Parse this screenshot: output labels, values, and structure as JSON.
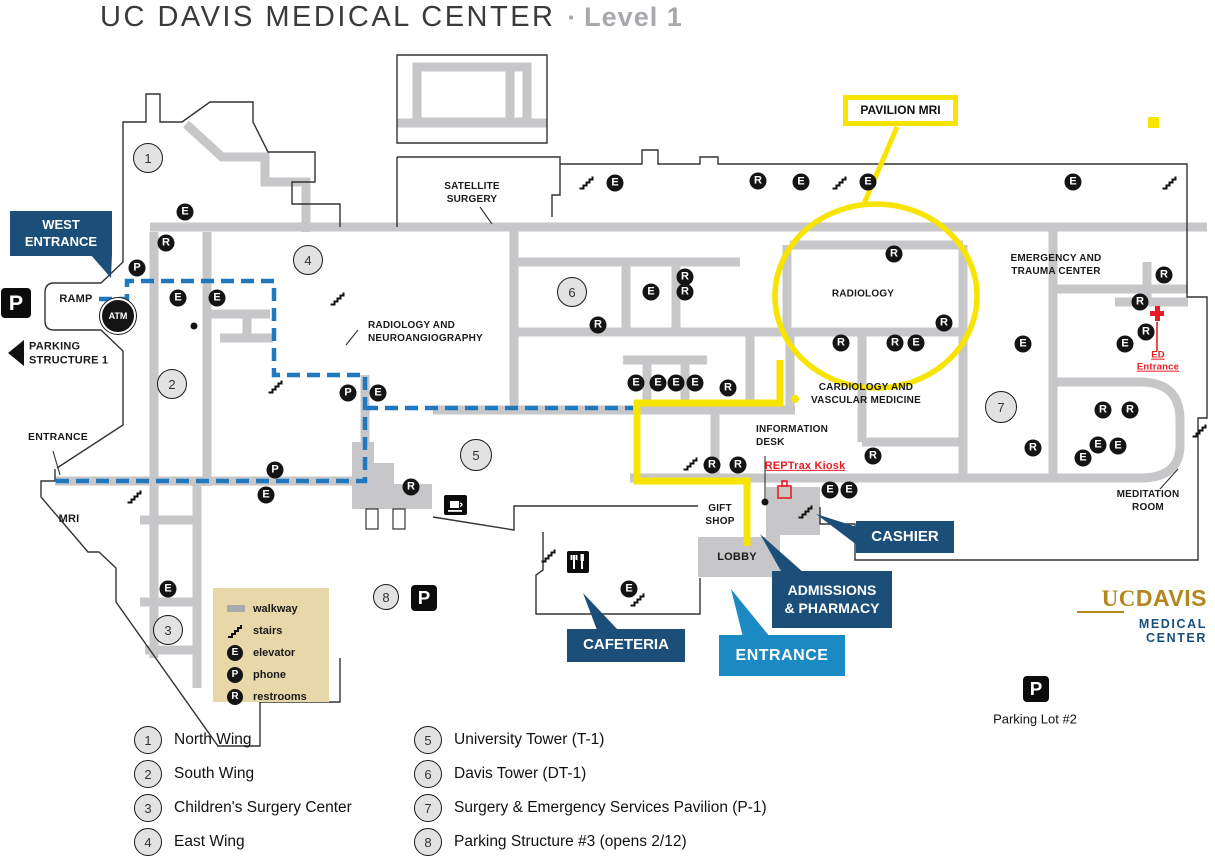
{
  "title": {
    "main": "UC DAVIS MEDICAL CENTER",
    "separator": "·",
    "level": "Level 1"
  },
  "colors": {
    "navy": "#1b4e79",
    "light_blue": "#1b8ac2",
    "yellow": "#f7e400",
    "route_blue": "#2079bf",
    "walkway_gray": "#c7c7c9",
    "legend_tan": "#e8d7a8",
    "red": "#e81c23",
    "gold": "#b3861e"
  },
  "map": {
    "labels": [
      {
        "id": "satellite-surgery",
        "text": "SATELLITE\nSURGERY",
        "x": 472,
        "y": 193
      },
      {
        "id": "radiology-neuro",
        "text": "RADIOLOGY AND\nNEUROANGIOGRAPHY",
        "x": 368,
        "y": 332,
        "align": "left"
      },
      {
        "id": "radiology",
        "text": "RADIOLOGY",
        "x": 863,
        "y": 294
      },
      {
        "id": "emergency-trauma",
        "text": "EMERGENCY AND\nTRAUMA CENTER",
        "x": 1056,
        "y": 265
      },
      {
        "id": "cardiology",
        "text": "CARDIOLOGY AND\nVASCULAR MEDICINE",
        "x": 866,
        "y": 394
      },
      {
        "id": "information-desk",
        "text": "INFORMATION\nDESK",
        "x": 756,
        "y": 436,
        "align": "left"
      },
      {
        "id": "gift-shop",
        "text": "GIFT\nSHOP",
        "x": 720,
        "y": 515
      },
      {
        "id": "lobby",
        "text": "LOBBY",
        "x": 737,
        "y": 557,
        "size": 11
      },
      {
        "id": "mri",
        "text": "MRI",
        "x": 69,
        "y": 519,
        "size": 11
      },
      {
        "id": "ramp",
        "text": "RAMP",
        "x": 76,
        "y": 299,
        "size": 11
      },
      {
        "id": "entrance-west-side",
        "text": "ENTRANCE",
        "x": 28,
        "y": 438,
        "align": "left",
        "size": 10.5
      },
      {
        "id": "meditation-room",
        "text": "MEDITATION\nROOM",
        "x": 1148,
        "y": 501
      },
      {
        "id": "parking-structure-1",
        "text": "PARKING\nSTRUCTURE 1",
        "x": 29,
        "y": 354,
        "align": "left",
        "size": 11
      },
      {
        "id": "ed-entrance",
        "text": "ED Entrance",
        "x": 1158,
        "y": 362,
        "color": "#e81c23",
        "size": 9.5,
        "underline": true
      },
      {
        "id": "reptrax-kiosk",
        "text": "REPTrax Kiosk",
        "x": 805,
        "y": 466,
        "color": "#e81c23",
        "size": 11,
        "underline": true
      },
      {
        "id": "parking-lot-2",
        "text": "Parking Lot #2",
        "x": 1035,
        "y": 719,
        "size": 13,
        "weight": "normal"
      }
    ],
    "markers": {
      "E": [
        [
          185,
          212
        ],
        [
          178,
          298
        ],
        [
          217,
          298
        ],
        [
          266,
          495
        ],
        [
          168,
          589
        ],
        [
          615,
          183
        ],
        [
          801,
          182
        ],
        [
          868,
          182
        ],
        [
          1073,
          182
        ],
        [
          651,
          292
        ],
        [
          636,
          383
        ],
        [
          658,
          383
        ],
        [
          676,
          383
        ],
        [
          695,
          383
        ],
        [
          378,
          393
        ],
        [
          830,
          490
        ],
        [
          849,
          490
        ],
        [
          916,
          343
        ],
        [
          1023,
          344
        ],
        [
          1125,
          344
        ],
        [
          1098,
          445
        ],
        [
          1118,
          446
        ],
        [
          1083,
          458
        ],
        [
          629,
          589
        ]
      ],
      "R": [
        [
          166,
          243
        ],
        [
          411,
          487
        ],
        [
          598,
          325
        ],
        [
          685,
          277
        ],
        [
          685,
          292
        ],
        [
          728,
          388
        ],
        [
          894,
          254
        ],
        [
          944,
          323
        ],
        [
          841,
          343
        ],
        [
          895,
          343
        ],
        [
          758,
          181
        ],
        [
          1164,
          275
        ],
        [
          1140,
          302
        ],
        [
          1146,
          332
        ],
        [
          873,
          456
        ],
        [
          712,
          465
        ],
        [
          738,
          465
        ],
        [
          1103,
          410
        ],
        [
          1130,
          410
        ],
        [
          1033,
          448
        ]
      ],
      "P": [
        [
          137,
          268
        ],
        [
          348,
          393
        ],
        [
          275,
          470
        ]
      ]
    },
    "stairs": [
      [
        587,
        182
      ],
      [
        840,
        182
      ],
      [
        1170,
        182
      ],
      [
        338,
        298
      ],
      [
        276,
        386
      ],
      [
        691,
        463
      ],
      [
        806,
        511
      ],
      [
        549,
        555
      ],
      [
        638,
        599
      ],
      [
        135,
        496
      ],
      [
        1200,
        430
      ]
    ],
    "parking_squares": [
      [
        16,
        303,
        30
      ],
      [
        424,
        598,
        26
      ],
      [
        1036,
        689,
        26
      ]
    ],
    "number_circles": [
      [
        1,
        148,
        158,
        28
      ],
      [
        2,
        172,
        384,
        28
      ],
      [
        3,
        168,
        630,
        28
      ],
      [
        4,
        308,
        260,
        28
      ],
      [
        5,
        476,
        455,
        30
      ],
      [
        6,
        572,
        292,
        28
      ],
      [
        7,
        1001,
        407,
        30
      ],
      [
        8,
        386,
        597,
        24
      ]
    ],
    "atm": {
      "label": "ATM",
      "x": 118,
      "y": 316
    },
    "dots": [
      [
        194,
        326
      ],
      [
        765,
        502
      ]
    ],
    "callouts": {
      "west_entrance": "WEST\nENTRANCE",
      "pavilion_mri": "PAVILION MRI",
      "cashier": "CASHIER",
      "admissions": "ADMISSIONS\n& PHARMACY",
      "cafeteria": "CAFETERIA",
      "entrance_main": "ENTRANCE"
    }
  },
  "legend": {
    "items": [
      {
        "icon": "walkway",
        "label": "walkway"
      },
      {
        "icon": "stairs",
        "label": "stairs"
      },
      {
        "icon": "E",
        "label": "elevator"
      },
      {
        "icon": "P",
        "label": "phone"
      },
      {
        "icon": "R",
        "label": "restrooms"
      }
    ]
  },
  "key": {
    "col1": [
      {
        "n": "1",
        "label": "North Wing"
      },
      {
        "n": "2",
        "label": "South Wing"
      },
      {
        "n": "3",
        "label": "Children's Surgery Center"
      },
      {
        "n": "4",
        "label": "East Wing"
      }
    ],
    "col2": [
      {
        "n": "5",
        "label": "University Tower (T-1)"
      },
      {
        "n": "6",
        "label": "Davis Tower (DT-1)"
      },
      {
        "n": "7",
        "label": "Surgery & Emergency Services Pavilion (P-1)"
      },
      {
        "n": "8",
        "label": "Parking Structure #3 (opens 2/12)"
      }
    ]
  },
  "logo": {
    "uc": "UC",
    "davis": "DAVIS",
    "line2": "MEDICAL CENTER"
  },
  "icons_key": {
    "E": "elevator-icon",
    "R": "restrooms-icon",
    "P": "phone-icon"
  }
}
